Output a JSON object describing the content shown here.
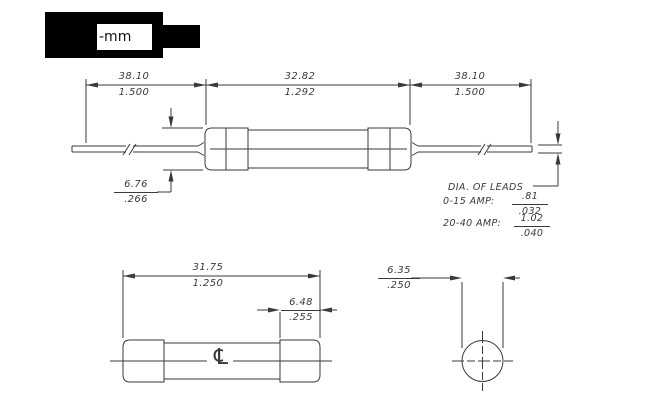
{
  "header": {
    "label": "-mm"
  },
  "top_view": {
    "dim_lead_left_mm": "38.10",
    "dim_lead_left_in": "1.500",
    "dim_body_mm": "32.82",
    "dim_body_in": "1.292",
    "dim_lead_right_mm": "38.10",
    "dim_lead_right_in": "1.500",
    "dim_cap_dia_mm": "6.76",
    "dim_cap_dia_in": ".266",
    "leads_note_title": "DIA. OF LEADS",
    "leads_note_row1_label": "0-15 AMP:",
    "leads_note_row1_mm": ".81",
    "leads_note_row1_in": ".032",
    "leads_note_row2_label": "20-40 AMP:",
    "leads_note_row2_mm": "1.02",
    "leads_note_row2_in": ".040"
  },
  "bottom_view": {
    "dim_body_mm": "31.75",
    "dim_body_in": "1.250",
    "dim_cap_mm": "6.48",
    "dim_cap_in": ".255",
    "centerline_symbol": "℄"
  },
  "end_view": {
    "dim_dia_mm": "6.35",
    "dim_dia_in": ".250"
  }
}
